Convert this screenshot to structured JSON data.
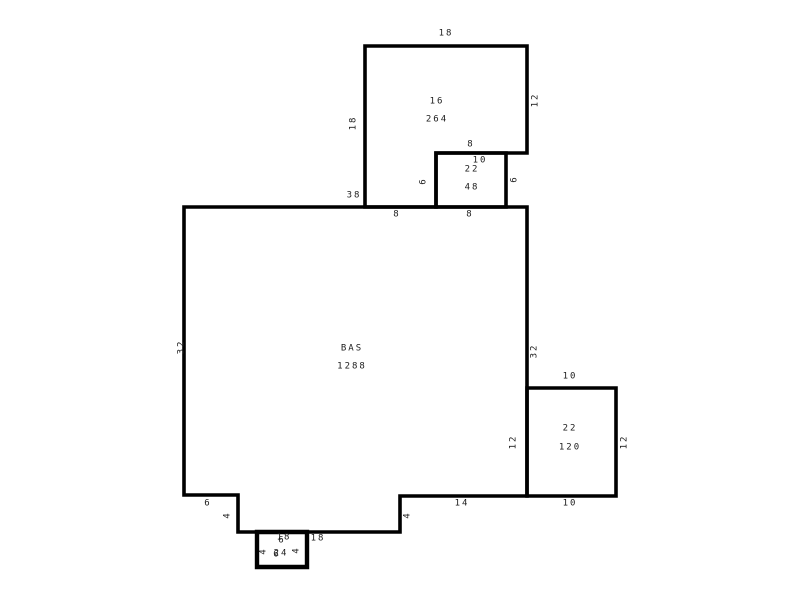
{
  "floorplan": {
    "type": "appraisal-sketch-floor-plan",
    "background_color": "#ffffff",
    "line_color": "#000000",
    "text_color": "#1b1b1b",
    "rooms": [
      {
        "name": "upper-room",
        "code": "16",
        "area": "264",
        "dims": {
          "top": "18",
          "left": "18",
          "right": "12",
          "bottom": "8",
          "notch": "10"
        }
      },
      {
        "name": "upper-small-room",
        "code": "22",
        "area": "48",
        "dims": {
          "top": "8",
          "left": "6",
          "right": "6",
          "bottom": "8"
        }
      },
      {
        "name": "base-area",
        "code": "BAS",
        "area": "1288",
        "dims": {
          "top": "38",
          "left": "32",
          "right": "32",
          "bottom_left": "6",
          "step_left": "4",
          "bottom_mid": "18",
          "step_right": "4",
          "bottom_right": "14"
        }
      },
      {
        "name": "right-room",
        "code": "22",
        "area": "120",
        "dims": {
          "top": "10",
          "left": "12",
          "right": "12",
          "bottom": "10"
        }
      },
      {
        "name": "stoop",
        "code": "18",
        "area": "24",
        "dims": {
          "top": "6",
          "left": "4",
          "right": "4",
          "bottom": "6"
        }
      }
    ]
  }
}
